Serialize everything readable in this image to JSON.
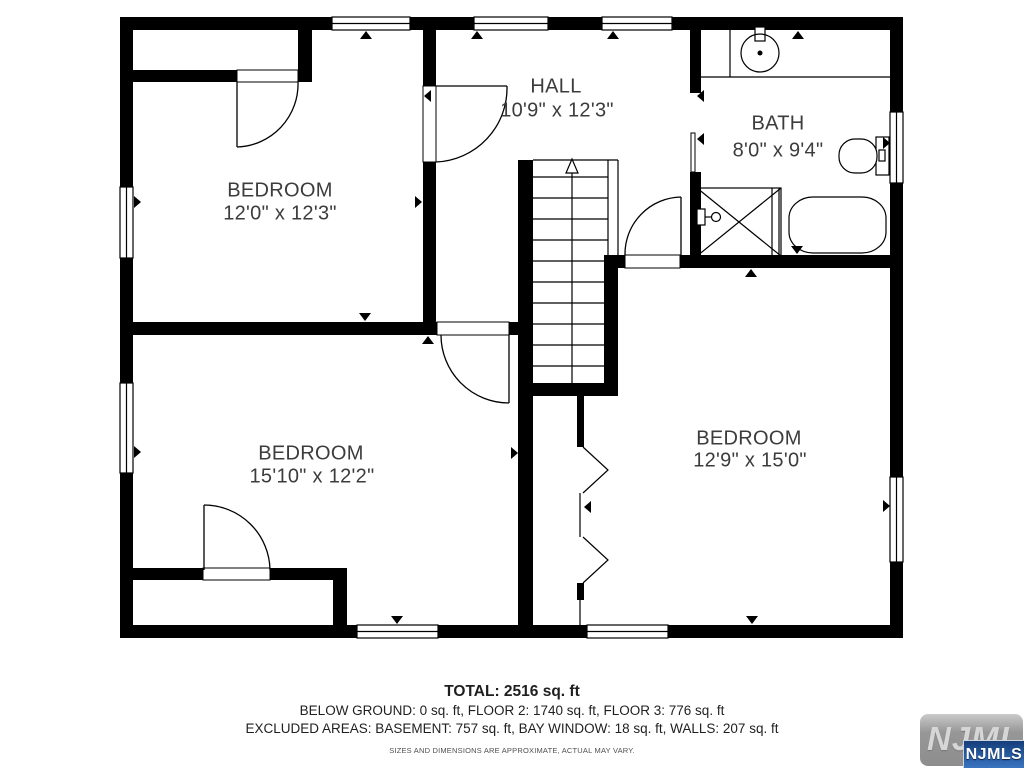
{
  "rooms": [
    {
      "name": "BEDROOM",
      "dims": "12'0\" x 12'3\""
    },
    {
      "name": "HALL",
      "dims": "10'9\" x 12'3\""
    },
    {
      "name": "BATH",
      "dims": "8'0\" x 9'4\""
    },
    {
      "name": "BEDROOM",
      "dims": "15'10\" x 12'2\""
    },
    {
      "name": "BEDROOM",
      "dims": "12'9\" x 15'0\""
    }
  ],
  "summary": {
    "total": "TOTAL: 2516 sq. ft",
    "floors": "BELOW GROUND: 0 sq. ft, FLOOR 2: 1740 sq. ft, FLOOR 3: 776 sq. ft",
    "excluded": "EXCLUDED AREAS: BASEMENT: 757 sq. ft, BAY WINDOW: 18 sq. ft, WALLS: 207 sq. ft",
    "disclaimer": "SIZES AND DIMENSIONS ARE APPROXIMATE, ACTUAL MAY VARY."
  },
  "logo": {
    "watermark": "NJMLS",
    "badge": "NJMLS"
  },
  "colors": {
    "walls": "#000000",
    "label_text": "#3c3c3c",
    "logo_badge_blue": "#275ca1"
  }
}
